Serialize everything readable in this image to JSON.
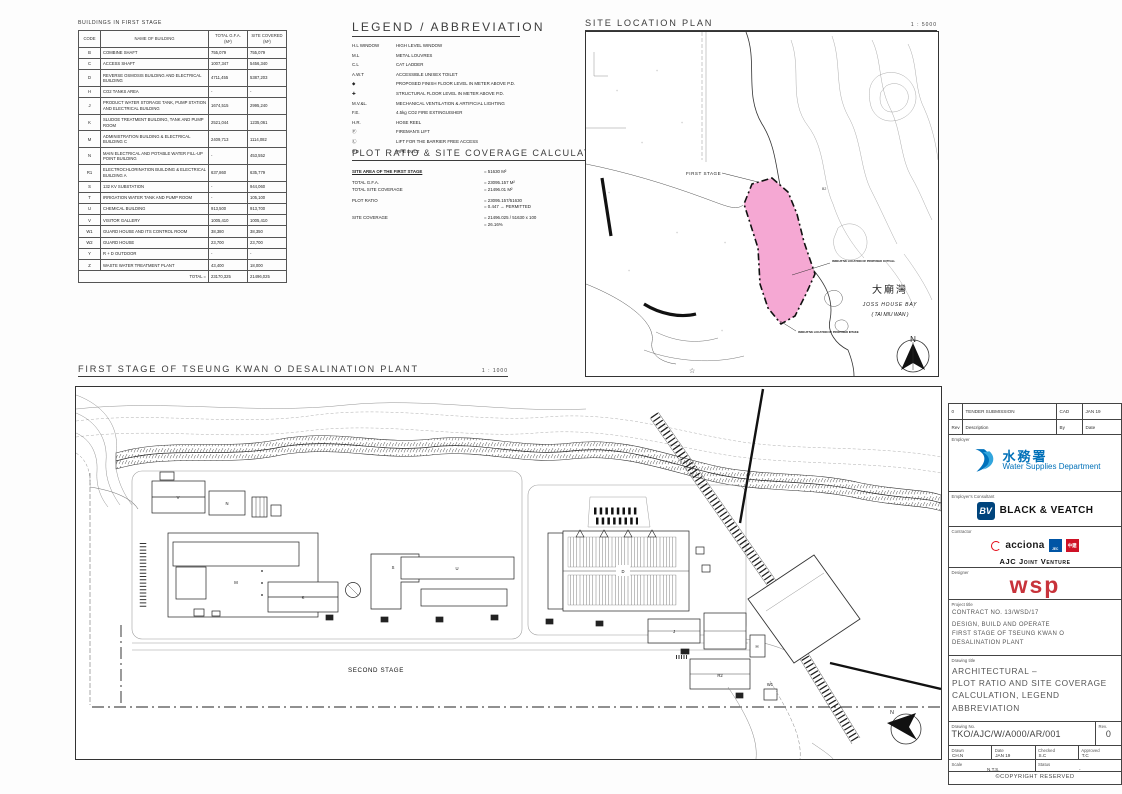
{
  "colors": {
    "highlight_pink": "#F5A8D3",
    "wsd_blue": "#0070B8",
    "bv_blue": "#00447C",
    "acciona_red": "#E30613",
    "ajc_blue": "#0055A5",
    "ajc_red": "#CE1126",
    "wsp_red": "#C8333B"
  },
  "buildings_table": {
    "title": "BUILDINGS IN FIRST STAGE",
    "headers": [
      "CODE",
      "NAME OF BUILDING",
      "TOTAL G.F.A. (M²)",
      "SITE COVERED (M²)"
    ],
    "rows": [
      [
        "B",
        "COMBINE SHAFT",
        "755,079",
        "755,079"
      ],
      [
        "C",
        "ACCESS SHAFT",
        "1007,347",
        "5456,340"
      ],
      [
        "D",
        "REVERSE OSMOSIS BUILDING AND ELECTRICAL BUILDING",
        "4711,455",
        "5387,203"
      ],
      [
        "H",
        "CO2 TANKS AREA",
        "-",
        "-"
      ],
      [
        "J",
        "PRODUCT WATER STORAGE TANK, PUMP STATION AND ELECTRICAL BUILDING",
        "1674,515",
        "2995,240"
      ],
      [
        "K",
        "SLUDGE TREATMENT BUILDING, TANK AND PUMP ROOM",
        "2521,044",
        "1235,061"
      ],
      [
        "M",
        "ADMINISTRATION BUILDING & ELECTRICAL BUILDING C",
        "2409,713",
        "1114,082"
      ],
      [
        "N",
        "MAIN ELECTRICAL AND POTABLE WATER FILL-UP POINT BUILDING",
        "-",
        "453,552"
      ],
      [
        "R1",
        "ELECTROCHLORINATION BUILDING & ELECTRICAL BUILDING A",
        "637,860",
        "635,779"
      ],
      [
        "S",
        "132 KV SUBSTATION",
        "-",
        "944,060"
      ],
      [
        "T",
        "IRRIGATION WATER TANK AND PUMP ROOM",
        "-",
        "105,100"
      ],
      [
        "U",
        "CHEMICAL BUILDING",
        "913,500",
        "913,700"
      ],
      [
        "V",
        "VISITOR GALLERY",
        "1005,410",
        "1005,410"
      ],
      [
        "W1",
        "GUARD HOUSE AND ITS CONTROL ROOM",
        "38,380",
        "38,350"
      ],
      [
        "W2",
        "GUARD HOUSE",
        "23,700",
        "23,700"
      ],
      [
        "Y",
        "R + D OUTDOOR",
        "-",
        "-"
      ],
      [
        "Z",
        "WASTE WATER TREATMENT PLANT",
        "43,400",
        "18,000"
      ]
    ],
    "total_label": "TOTAL =",
    "total_gfa": "23170,325",
    "total_covered": "21496,025"
  },
  "legend": {
    "title": "LEGEND / ABBREVIATION",
    "items": [
      {
        "sym": "H.L WINDOW",
        "text": "HIGH LEVEL WINDOW"
      },
      {
        "sym": "M.L",
        "text": "METAL LOUVRES"
      },
      {
        "sym": "C.L",
        "text": "CAT LADDER"
      },
      {
        "sym": "A.W.T",
        "text": "ACCESSIBLE UNISEX TOILET"
      },
      {
        "sym": "◆",
        "text": "PROPOSED FINISH FLOOR LEVEL IN METER ABOVE P.D."
      },
      {
        "sym": "✚",
        "text": "STRUCTURAL FLOOR LEVEL IN METER ABOVE P.D."
      },
      {
        "sym": "M.V.&L.",
        "text": "MECHANICAL VENTILATION & ARTIFICIAL LIGHTING"
      },
      {
        "sym": "F.E.",
        "text": "4.5kg CO2 FIRE EXTINGUISHER"
      },
      {
        "sym": "H.R.",
        "text": "HOSE REEL"
      },
      {
        "sym": "Ⓕ",
        "text": "FIREMAN'S LIFT"
      },
      {
        "sym": "Ⓛ",
        "text": "LIFT FOR THE BARRIER FREE ACCESS"
      },
      {
        "sym": "P.D",
        "text": "PIPE DUCT"
      }
    ]
  },
  "plot_ratio": {
    "title": "PLOT RATIO & SITE COVERAGE CALCULATION:",
    "lines": [
      {
        "label": "SITE AREA OF THE FIRST STAGE",
        "value": "=  51630 M²"
      },
      {
        "label": "",
        "value": ""
      },
      {
        "label": "TOTAL G.F.A.",
        "value": "=  23095.157 M²"
      },
      {
        "label": "TOTAL SITE COVERAGE",
        "value": "=  21496.01 M²"
      },
      {
        "label": "",
        "value": ""
      },
      {
        "label": "PLOT RATIO",
        "value": "=  23095.157/51630"
      },
      {
        "label": "",
        "value": "=  0.447  →  PERMITTED"
      },
      {
        "label": "",
        "value": ""
      },
      {
        "label": "SITE COVERAGE",
        "value": "=  21496.025 / 51630 x 100"
      },
      {
        "label": "",
        "value": "=  26.16%"
      }
    ]
  },
  "site_location": {
    "title": "SITE LOCATION PLAN",
    "scale": "1 : 5000",
    "first_stage_label": "FIRST STAGE",
    "hill_label": "B2",
    "callout1": "INDICATIVE LOCATION OF PROPOSED OUTFALL",
    "callout2": "INDICATIVE LOCATION OF PROPOSED INTAKE",
    "bay_cn": "大廟灣",
    "bay_en": "JOSS HOUSE BAY",
    "bay_en2": "( TAI MIU WAN )",
    "north": "N",
    "star": "☆"
  },
  "main_plan": {
    "title": "FIRST STAGE OF TSEUNG KWAN O DESALINATION PLANT",
    "scale": "1 : 1000",
    "second_stage_label": "SECOND STAGE",
    "north": "N",
    "building_labels": [
      "V",
      "N",
      "M",
      "K",
      "D",
      "U",
      "S",
      "J",
      "H",
      "R2",
      "W1"
    ]
  },
  "title_block": {
    "rev_row": {
      "rev": "0",
      "description": "TENDER SUBMISSION",
      "by": "CAD",
      "date": "JAN 19"
    },
    "rev_headers": {
      "rev": "Rev",
      "description": "Description",
      "by": "By",
      "date": "Date"
    },
    "employer_label": "Employer",
    "employer_cn": "水務署",
    "employer_en1": "Water Supplies",
    "employer_en2": "Department",
    "consultant_label": "Employer's Consultant",
    "consultant_bv": "BV",
    "consultant_name": "BLACK & VEATCH",
    "contractor_label": "Contractor",
    "contractor_acciona": "acciona",
    "contractor_sq1": "JEC",
    "contractor_sq2": "中建",
    "contractor_name": "AJC Joint Venture",
    "designer_label": "Designer",
    "designer_name": "wsp",
    "project_label": "Project title",
    "project_line1": "CONTRACT NO. 13/WSD/17",
    "project_line2": "DESIGN, BUILD AND OPERATE",
    "project_line3": "FIRST STAGE OF TSEUNG KWAN O",
    "project_line4": "DESALINATION PLANT",
    "drawing_label": "Drawing title",
    "drawing_line1": "ARCHITECTURAL –",
    "drawing_line2": "PLOT RATIO AND SITE COVERAGE",
    "drawing_line3": "CALCULATION, LEGEND",
    "drawing_line4": "ABBREVIATION",
    "drawing_no_label": "Drawing No.",
    "drawing_no": "TKO/AJC/W/A000/AR/001",
    "rev_label": "Rev.",
    "rev_value": "0",
    "drawn_label": "Drawn",
    "drawn": "CH.N",
    "date_label": "Date",
    "date": "JAN 19",
    "checked_label": "Checked",
    "checked": "S.C",
    "approved_label": "Approved",
    "approved": "T.C",
    "scale_label": "Scale",
    "scale": "N.T.S.",
    "status_label": "Status",
    "status": "-",
    "copyright": "©COPYRIGHT RESERVED"
  }
}
